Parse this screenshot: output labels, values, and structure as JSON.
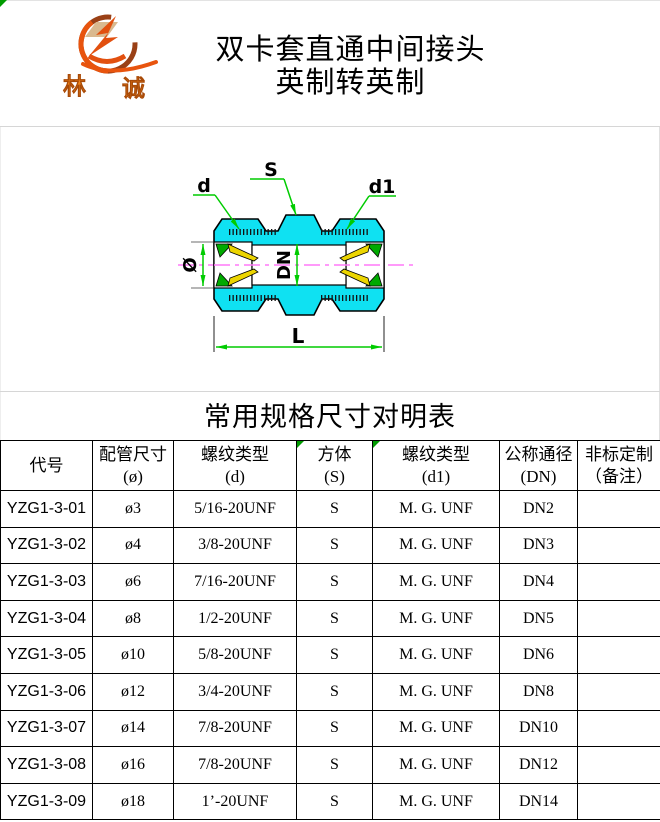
{
  "header": {
    "logo": {
      "char_left": "林",
      "char_right": "诚"
    },
    "title_line1": "双卡套直通中间接头",
    "title_line2": "英制转英制"
  },
  "diagram": {
    "labels": {
      "s": "S",
      "d": "d",
      "d1": "d1",
      "dia": "Ø",
      "dn": "DN",
      "l": "L"
    },
    "colors": {
      "body_cyan": "#0fe1f2",
      "dimension_green": "#00cc00",
      "centerline_magenta": "#ff78f8",
      "ferrule_yellow": "#ecd500",
      "ferrule_green": "#00aa00"
    }
  },
  "table": {
    "title": "常用规格尺寸对明表",
    "headers": [
      {
        "key": "code",
        "line1": "代号",
        "line2": "",
        "marker": false
      },
      {
        "key": "pipe-size",
        "line1": "配管尺寸",
        "line2": "(ø)",
        "marker": false
      },
      {
        "key": "thread-d",
        "line1": "螺纹类型",
        "line2": "(d)",
        "marker": false
      },
      {
        "key": "hex-s",
        "line1": "方体",
        "line2": "(S)",
        "marker": true
      },
      {
        "key": "thread-d1",
        "line1": "螺纹类型",
        "line2": "(d1)",
        "marker": true
      },
      {
        "key": "dn",
        "line1": "公称通径",
        "line2": "(DN)",
        "marker": false
      },
      {
        "key": "custom",
        "line1": "非标定制",
        "line2": "（备注）",
        "marker": false
      }
    ],
    "rows": [
      [
        "YZG1-3-01",
        "ø3",
        "5/16-20UNF",
        "S",
        "M. G. UNF",
        "DN2",
        ""
      ],
      [
        "YZG1-3-02",
        "ø4",
        "3/8-20UNF",
        "S",
        "M. G. UNF",
        "DN3",
        ""
      ],
      [
        "YZG1-3-03",
        "ø6",
        "7/16-20UNF",
        "S",
        "M. G. UNF",
        "DN4",
        ""
      ],
      [
        "YZG1-3-04",
        "ø8",
        "1/2-20UNF",
        "S",
        "M. G. UNF",
        "DN5",
        ""
      ],
      [
        "YZG1-3-05",
        "ø10",
        "5/8-20UNF",
        "S",
        "M. G. UNF",
        "DN6",
        ""
      ],
      [
        "YZG1-3-06",
        "ø12",
        "3/4-20UNF",
        "S",
        "M. G. UNF",
        "DN8",
        ""
      ],
      [
        "YZG1-3-07",
        "ø14",
        "7/8-20UNF",
        "S",
        "M. G. UNF",
        "DN10",
        ""
      ],
      [
        "YZG1-3-08",
        "ø16",
        "7/8-20UNF",
        "S",
        "M. G. UNF",
        "DN12",
        ""
      ],
      [
        "YZG1-3-09",
        "ø18",
        "1’-20UNF",
        "S",
        "M. G. UNF",
        "DN14",
        ""
      ]
    ]
  }
}
